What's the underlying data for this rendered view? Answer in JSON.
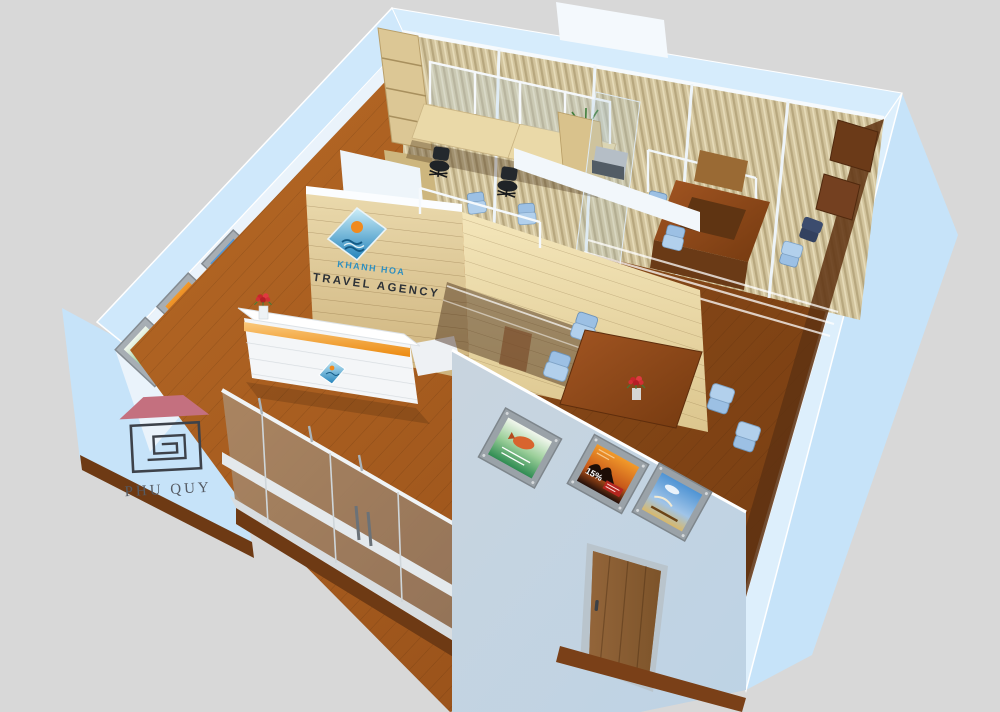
{
  "scene": {
    "type": "3d-interior-render",
    "subject": "travel agency office cutaway floor plan, isometric top view"
  },
  "branding": {
    "logo_text": "PHU QUY"
  },
  "signage": {
    "company": "KHANH HOA",
    "tagline": "TRAVEL AGENCY"
  },
  "posters": {
    "front_wall": [
      {
        "name": "tropical-fish-poster",
        "theme": "green sea / fish"
      },
      {
        "name": "desert-discount-poster",
        "theme": "orange desert camels",
        "label": "15%"
      },
      {
        "name": "beach-poster",
        "theme": "blue sky beach"
      }
    ],
    "left_wall": [
      {
        "name": "fish-travel-poster",
        "theme": "white/green fish"
      },
      {
        "name": "desert-travel-poster",
        "theme": "orange desert camels"
      },
      {
        "name": "beach-travel-poster",
        "theme": "blue beach"
      }
    ],
    "discount_label": "15%"
  },
  "palette": {
    "background": "#d8d8d8",
    "wall_blue": "#c6e3f9",
    "wall_blue_light": "#ddeffc",
    "wall_white": "#eaf3fb",
    "front_wall": "#c3cfda",
    "floor_wood": "#b05f20",
    "floor_wood_dark": "#8a4414",
    "sign_wood": "#dcc global",
    "blinds": "#cfc19b",
    "chair_blue": "#aecdec",
    "accent_orange": "#f0971f",
    "logo_blue": "#2e8fc0",
    "sun_orange": "#f08a1e",
    "roof_pink": "#c4707f",
    "logo_outline": "#3d424a",
    "logo_text_gray": "#565b63",
    "tagline_dark": "#2e3237",
    "door_wood": "#8a5c33"
  }
}
